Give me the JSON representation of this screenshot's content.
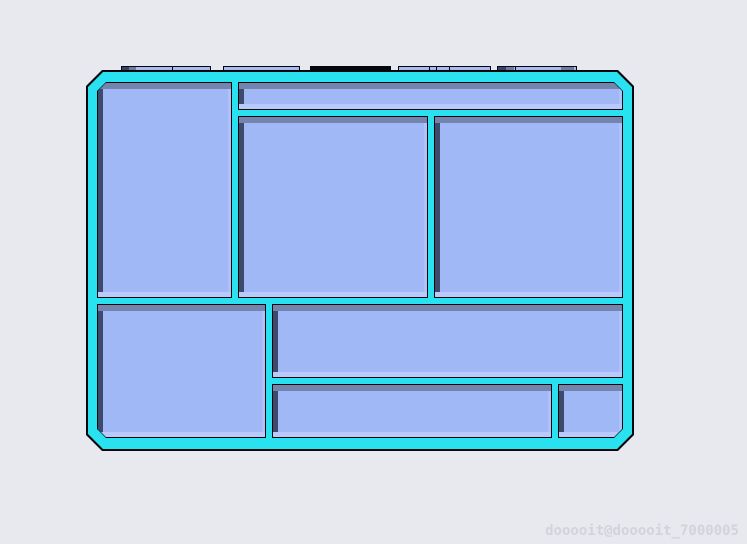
{
  "scene": {
    "background_color": "#e8e9ee",
    "watermark": {
      "text": "dooooit@dooooit_7000005",
      "color": "#d1d4db"
    }
  },
  "model": {
    "description": "3d-render-of-compartment-storage-tray",
    "colors": {
      "frame": "#2ae1f0",
      "outline": "#05070d",
      "floor": "#a0b8f5",
      "wall_top": "#7384ae",
      "wall_left": "#3e4a6c",
      "wall_bottom": "#b9c9fb",
      "wall_right": "#aec1f8",
      "tab_fill": "#a7bbf0",
      "tab_dark": "#39426a",
      "tab_mid": "#6e7a9e"
    },
    "frame": {
      "x": 88,
      "y": 72,
      "w": 544,
      "h": 377,
      "chamfer": 15
    },
    "compartments": [
      {
        "id": "top-left",
        "x": 98,
        "y": 83,
        "w": 133,
        "h": 214,
        "chamfer": "tl"
      },
      {
        "id": "top-strip",
        "x": 239,
        "y": 83,
        "w": 383,
        "h": 26,
        "chamfer": "tr"
      },
      {
        "id": "middle",
        "x": 239,
        "y": 117,
        "w": 188,
        "h": 180,
        "chamfer": ""
      },
      {
        "id": "right",
        "x": 435,
        "y": 117,
        "w": 187,
        "h": 180,
        "chamfer": ""
      },
      {
        "id": "bottom-left",
        "x": 98,
        "y": 305,
        "w": 167,
        "h": 132,
        "chamfer": "bl"
      },
      {
        "id": "mid-wide",
        "x": 273,
        "y": 305,
        "w": 349,
        "h": 72,
        "chamfer": ""
      },
      {
        "id": "bottom-strip",
        "x": 273,
        "y": 385,
        "w": 278,
        "h": 52,
        "chamfer": ""
      },
      {
        "id": "bottom-right-small",
        "x": 559,
        "y": 385,
        "w": 63,
        "h": 52,
        "chamfer": "br"
      }
    ],
    "tabs": [
      {
        "x": 121,
        "y": 66,
        "w": 90,
        "h": 8,
        "dark_top": false,
        "segments": [
          {
            "x": 0,
            "w": 7,
            "tone": "dark"
          },
          {
            "x": 7,
            "w": 7,
            "tone": "mid"
          }
        ],
        "dividers": [
          50
        ]
      },
      {
        "x": 223,
        "y": 66,
        "w": 77,
        "h": 8,
        "dark_top": false,
        "segments": [],
        "dividers": []
      },
      {
        "x": 310,
        "y": 66,
        "w": 81,
        "h": 8,
        "dark_top": true,
        "segments": [],
        "dividers": []
      },
      {
        "x": 398,
        "y": 66,
        "w": 93,
        "h": 8,
        "dark_top": false,
        "segments": [],
        "dividers": [
          30,
          37,
          50
        ]
      },
      {
        "x": 497,
        "y": 66,
        "w": 80,
        "h": 8,
        "dark_top": false,
        "segments": [
          {
            "x": 0,
            "w": 8,
            "tone": "dark"
          },
          {
            "x": 8,
            "w": 8,
            "tone": "mid"
          },
          {
            "x": 63,
            "w": 13,
            "tone": "mid"
          }
        ],
        "dividers": [
          17
        ]
      }
    ]
  }
}
